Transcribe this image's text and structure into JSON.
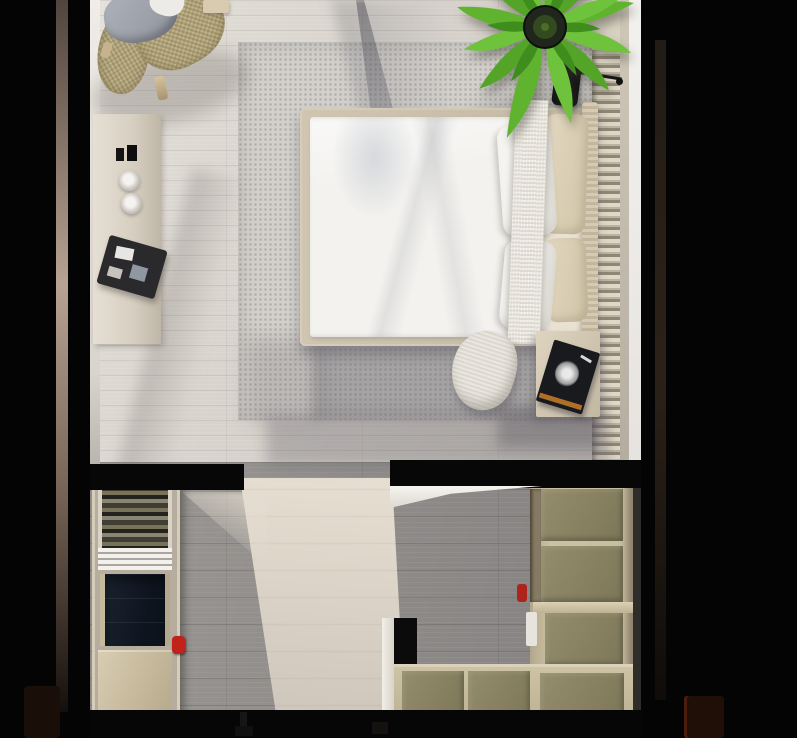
{
  "scene": {
    "title": "top-down-studio-bedroom-render",
    "style": "photorealistic 3D architectural top view, no visible text",
    "palette": {
      "background": "#040404",
      "bedroom_floor": "#d6d1ca",
      "rug": "#d3d0cb",
      "bed_frame_tan": "#c7bda8",
      "duvet_white": "#f3f2ef",
      "pillow_beige": "#d9cdb1",
      "headboard_tan": "#cec3ab",
      "slat_panel_light": "#e0d8c6",
      "wall_highlight_white": "#f1efeb",
      "closet_floor_shadow": "#8d8a88",
      "closet_floor_lit": "#ddd5c9",
      "olive_panel": "#8a8363",
      "olive_frame": "#c9bda0",
      "navy_drawers": "#131b26",
      "wardrobe_wood": "#cdc0a4",
      "accent_red": "#bf2319",
      "plant_green": "#5fb32f",
      "blanket_gray": "#9aa0a8",
      "rattan_tan": "#b2a478"
    },
    "rooms": [
      {
        "name": "bedroom",
        "items": [
          {
            "label": "rattan lounge chair with gray blanket"
          },
          {
            "label": "wood console sideboard with candles, jars and book tray"
          },
          {
            "label": "dotted area rug"
          },
          {
            "label": "double bed with white duvet, knit runner, beige and white pillows"
          },
          {
            "label": "slatted headboard wall panel"
          },
          {
            "label": "potted palm plant"
          },
          {
            "label": "black wall lamp"
          },
          {
            "label": "nightstand with dark book stack"
          }
        ]
      },
      {
        "name": "closet-room",
        "items": [
          {
            "label": "open wardrobe rack with clothes"
          },
          {
            "label": "white folded-clothes shelf"
          },
          {
            "label": "navy drawer unit"
          },
          {
            "label": "wood base cabinet"
          },
          {
            "label": "red accent object"
          },
          {
            "label": "olive-front wardrobe column"
          },
          {
            "label": "olive-front wardrobe bottom row"
          },
          {
            "label": "black floor box"
          },
          {
            "label": "doorway light beam across shadowed floor"
          }
        ]
      }
    ]
  }
}
